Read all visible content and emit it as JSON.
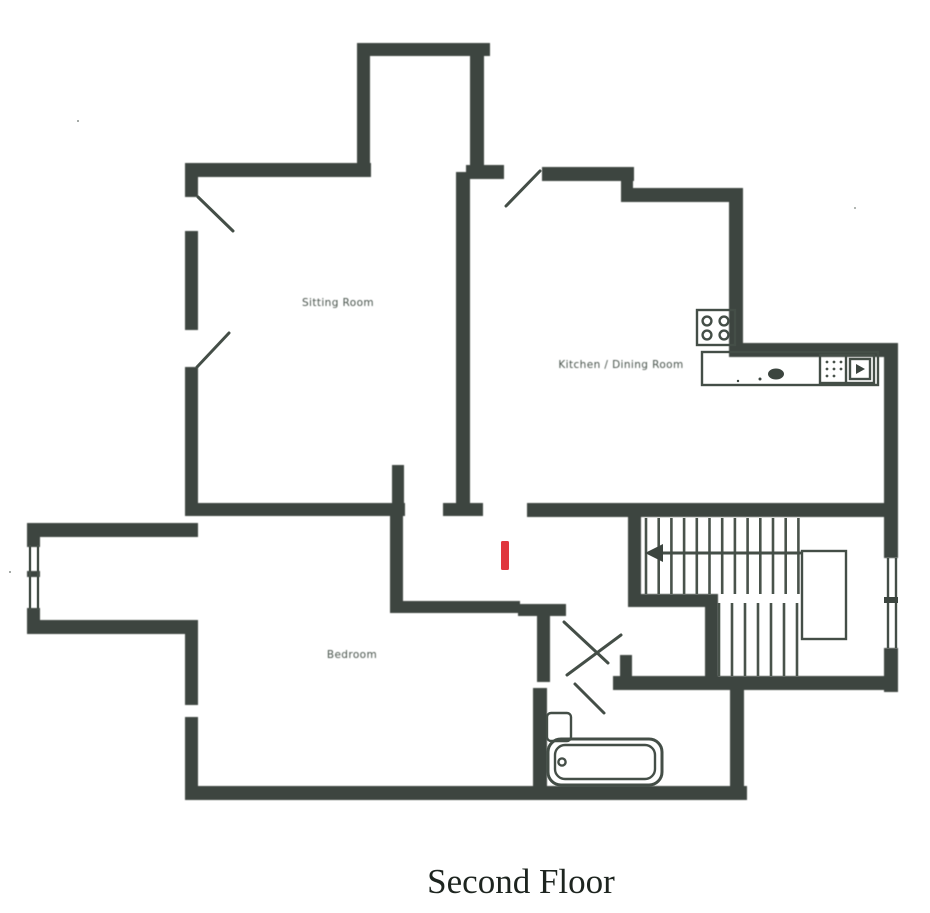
{
  "document": {
    "kind": "scanned architectural floor plan",
    "title": "Second Floor"
  },
  "rooms": [
    {
      "id": "sitting-room",
      "label": "Sitting Room"
    },
    {
      "id": "kitchen-dining-room",
      "label": "Kitchen / Dining Room"
    },
    {
      "id": "bedroom",
      "label": "Bedroom"
    }
  ],
  "features": {
    "staircase": {
      "direction_arrow": "left",
      "upper_treads": 13,
      "lower_treads": 7
    },
    "bathroom": {
      "fixtures": [
        "bathtub",
        "toilet"
      ]
    },
    "kitchen": {
      "fixtures": [
        "hob",
        "counter",
        "sink"
      ]
    },
    "windows": [
      "left-corridor-end",
      "right-stair-wall"
    ]
  },
  "marker": {
    "color": "#e0363d",
    "description": "red vertical bar annotation in central hallway"
  },
  "colors": {
    "walls": "#3c453f",
    "background": "#ffffff",
    "title": "#1d241f",
    "labels": "#4a544d"
  }
}
